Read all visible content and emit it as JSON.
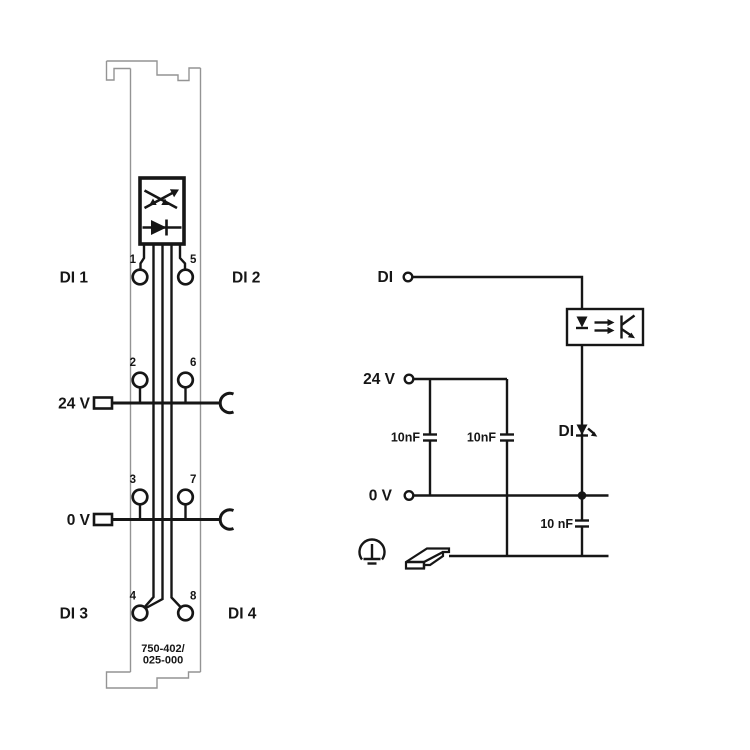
{
  "colors": {
    "ink": "#161616",
    "outline": "#949494",
    "background": "#ffffff"
  },
  "module": {
    "part_line1": "750-402/",
    "part_line2": "025-000",
    "labels": {
      "di1": "DI 1",
      "di2": "DI 2",
      "di3": "DI 3",
      "di4": "DI 4",
      "v24": "24 V",
      "v0": "0 V"
    },
    "terminals": [
      "1",
      "5",
      "2",
      "6",
      "3",
      "7",
      "4",
      "8"
    ]
  },
  "schematic": {
    "di": "DI",
    "v24": "24 V",
    "v0": "0 V",
    "led_di": "DI",
    "cap1": "10nF",
    "cap2": "10nF",
    "cap3": "10 nF"
  }
}
